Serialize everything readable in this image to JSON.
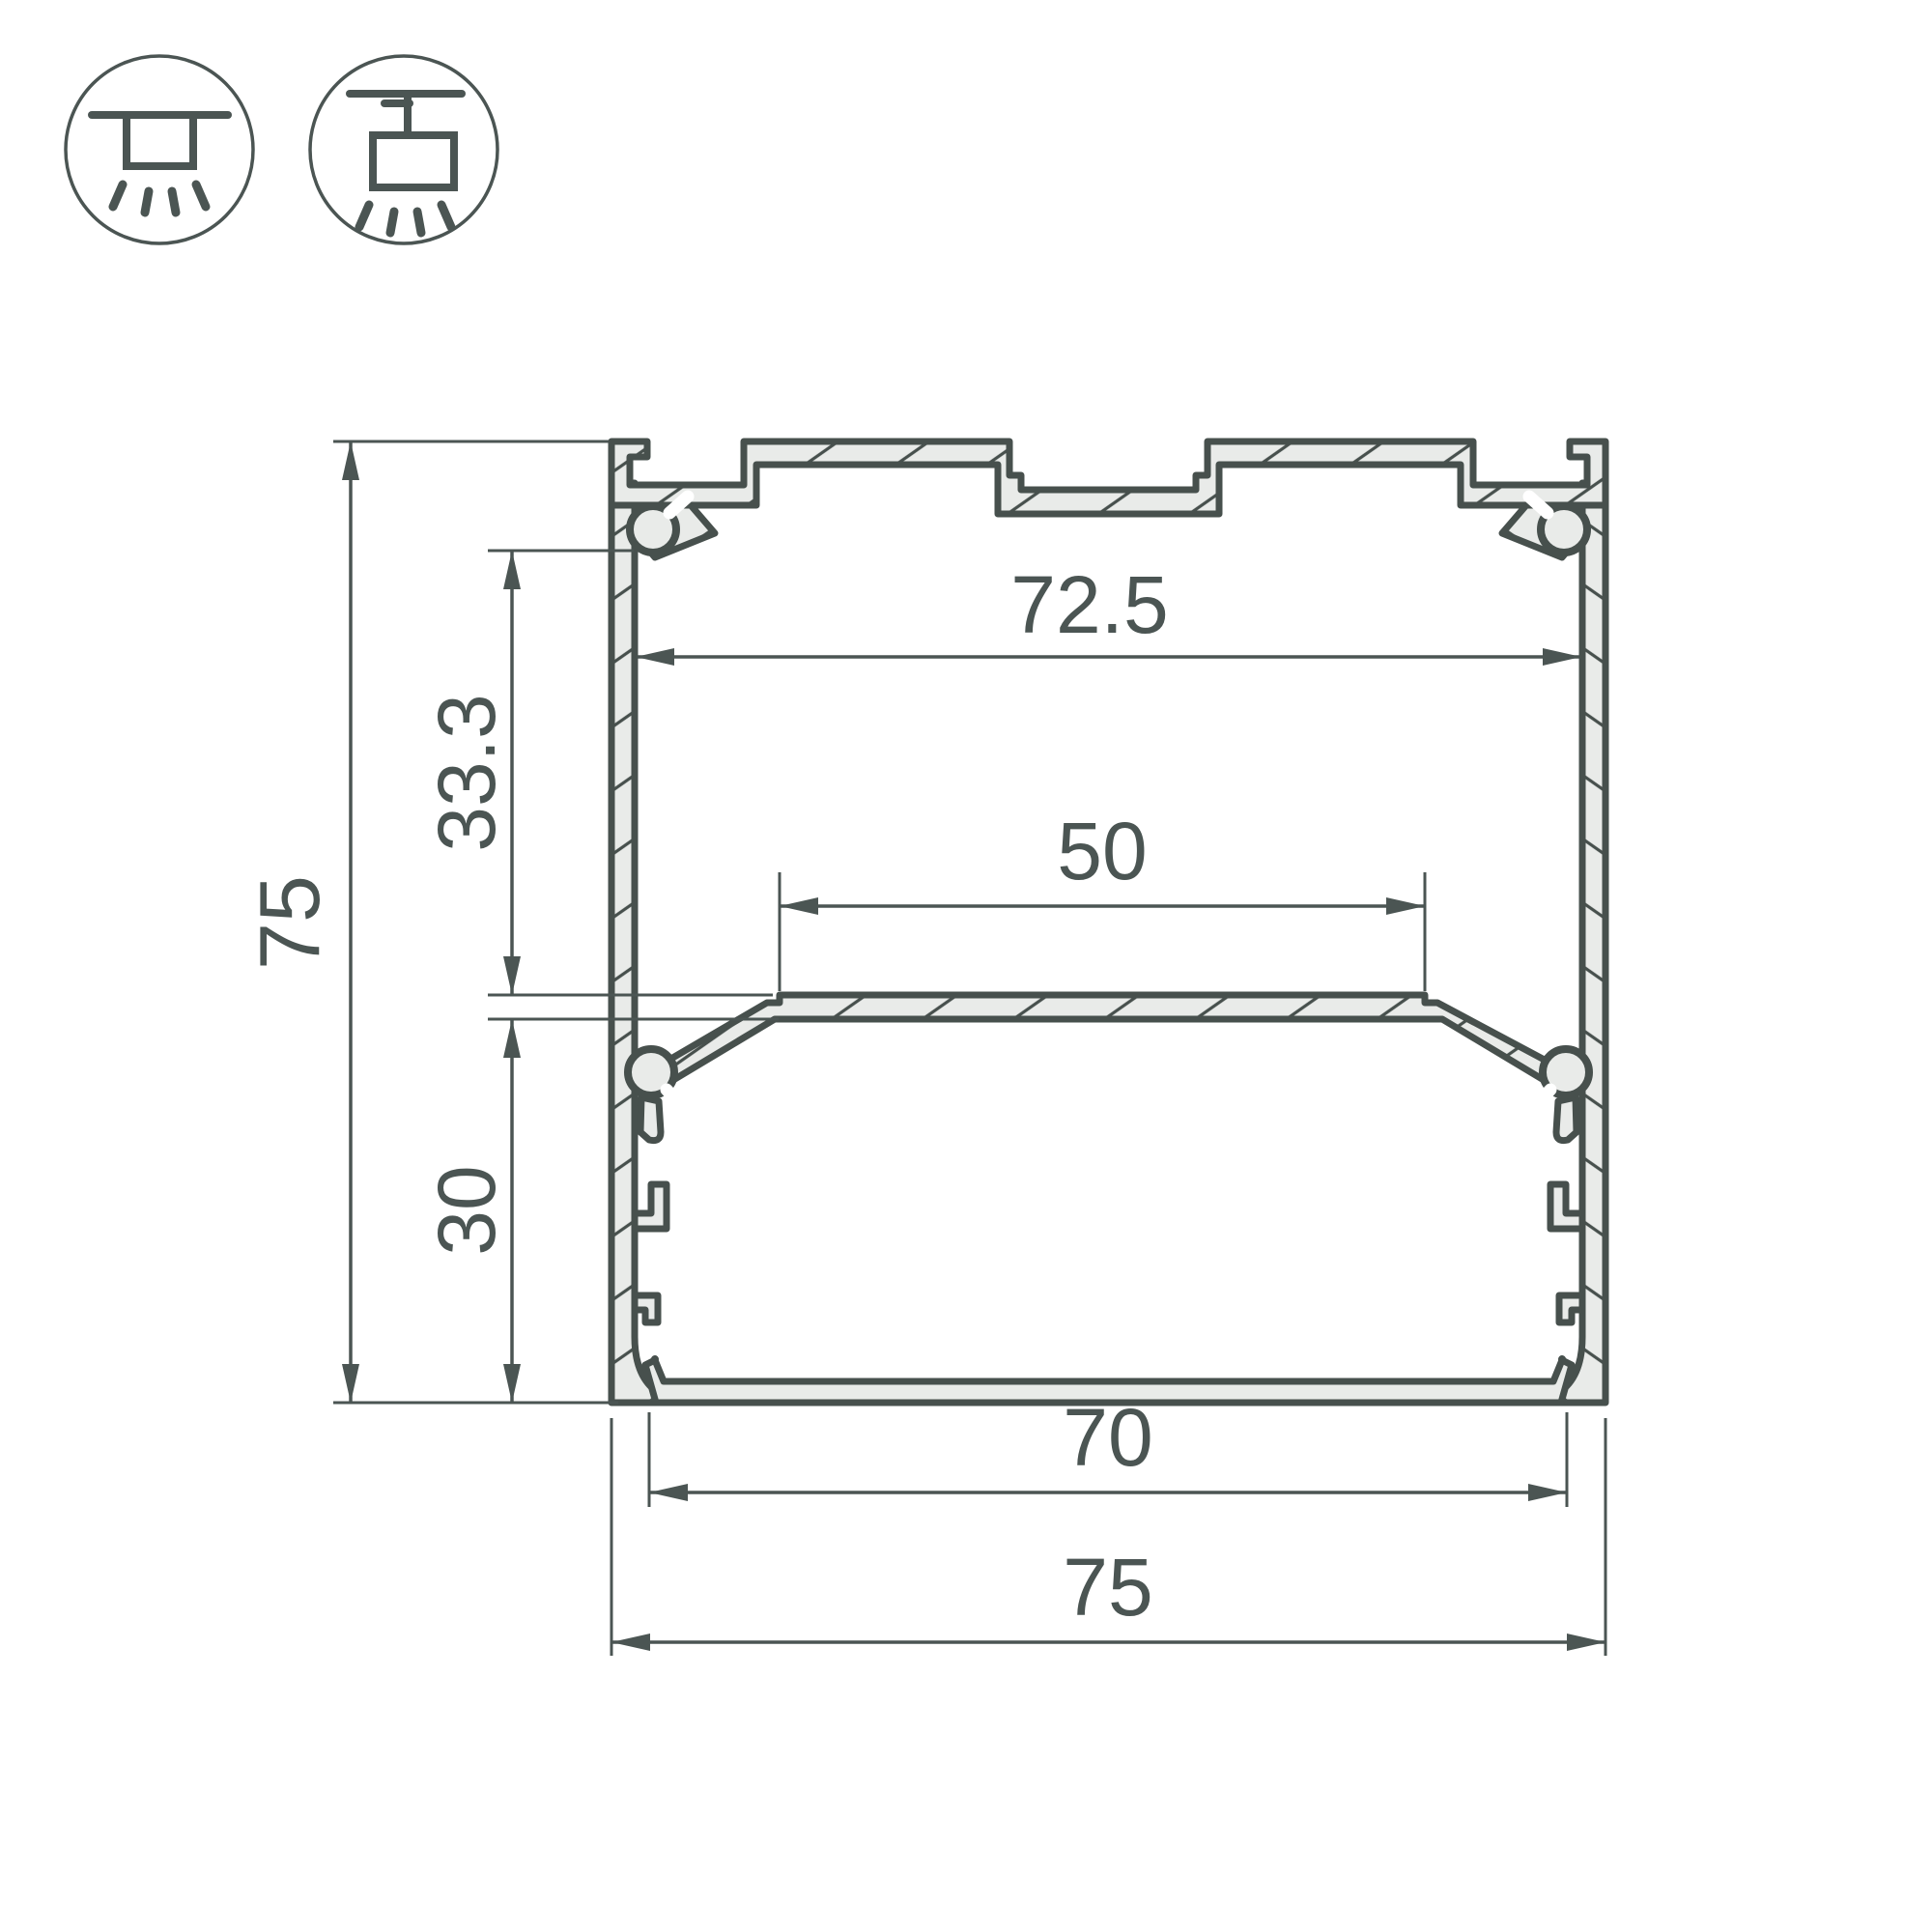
{
  "drawing": {
    "kind": "aluminium-led-profile-cross-section"
  },
  "icons": {
    "surface_mount": "surface-mount-luminaire-icon",
    "pendant_mount": "pendant-mount-luminaire-icon"
  },
  "dimensions": {
    "inner_top_width": "72.5",
    "led_shelf_width": "50",
    "top_to_shelf_height": "33.3",
    "shelf_to_bottom_height": "30",
    "overall_height": "75",
    "inner_bottom_width": "70",
    "overall_width": "75"
  },
  "colors": {
    "outline": "#47504d",
    "dimension": "#4b5553",
    "aluminium_fill": "#e9ebe9",
    "background": "#ffffff"
  }
}
